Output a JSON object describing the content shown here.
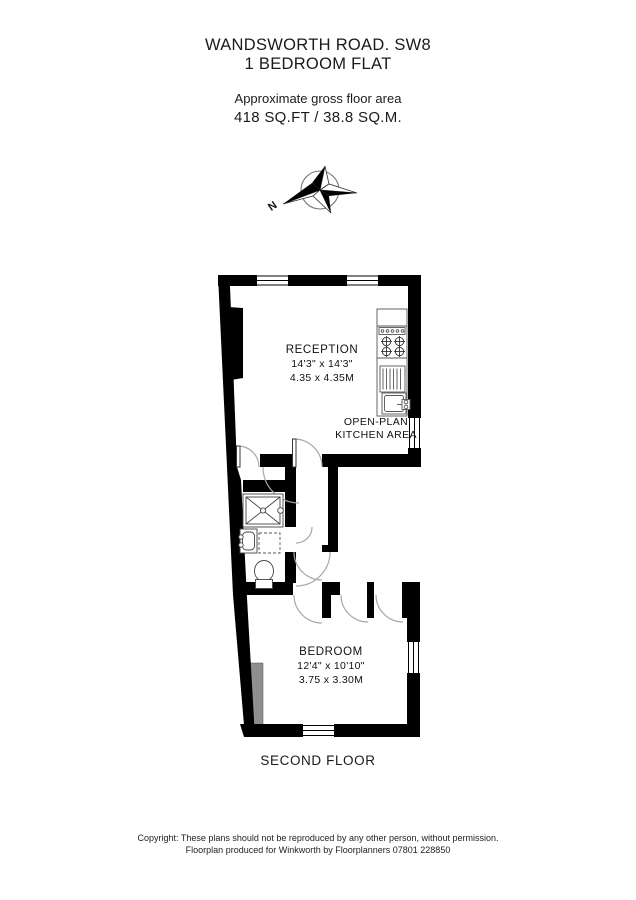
{
  "header": {
    "address": "WANDSWORTH ROAD. SW8",
    "subtitle": "1 BEDROOM FLAT",
    "area_label": "Approximate gross floor area",
    "area_value": "418 SQ.FT / 38.8 SQ.M."
  },
  "compass": {
    "north_label": "N"
  },
  "plan": {
    "reception": {
      "name": "RECEPTION",
      "dims_imperial": "14'3\" x 14'3\"",
      "dims_metric": "4.35 x 4.35M"
    },
    "kitchen": {
      "line1": "OPEN-PLAN",
      "line2": "KITCHEN AREA"
    },
    "bedroom": {
      "name": "BEDROOM",
      "dims_imperial": "12'4\" x 10'10\"",
      "dims_metric": "3.75 x 3.30M"
    },
    "floor_label": "SECOND FLOOR"
  },
  "footer": {
    "copyright_line1": "Copyright: These plans should not be reproduced by any other person, without permission.",
    "copyright_line2": "Floorplan produced for Winkworth by Floorplanners 07801 228850"
  },
  "colors": {
    "wall": "#000000",
    "fixture": "#444444",
    "door_arc": "#a8a8a8",
    "void_gray": "#8f8f8f"
  }
}
